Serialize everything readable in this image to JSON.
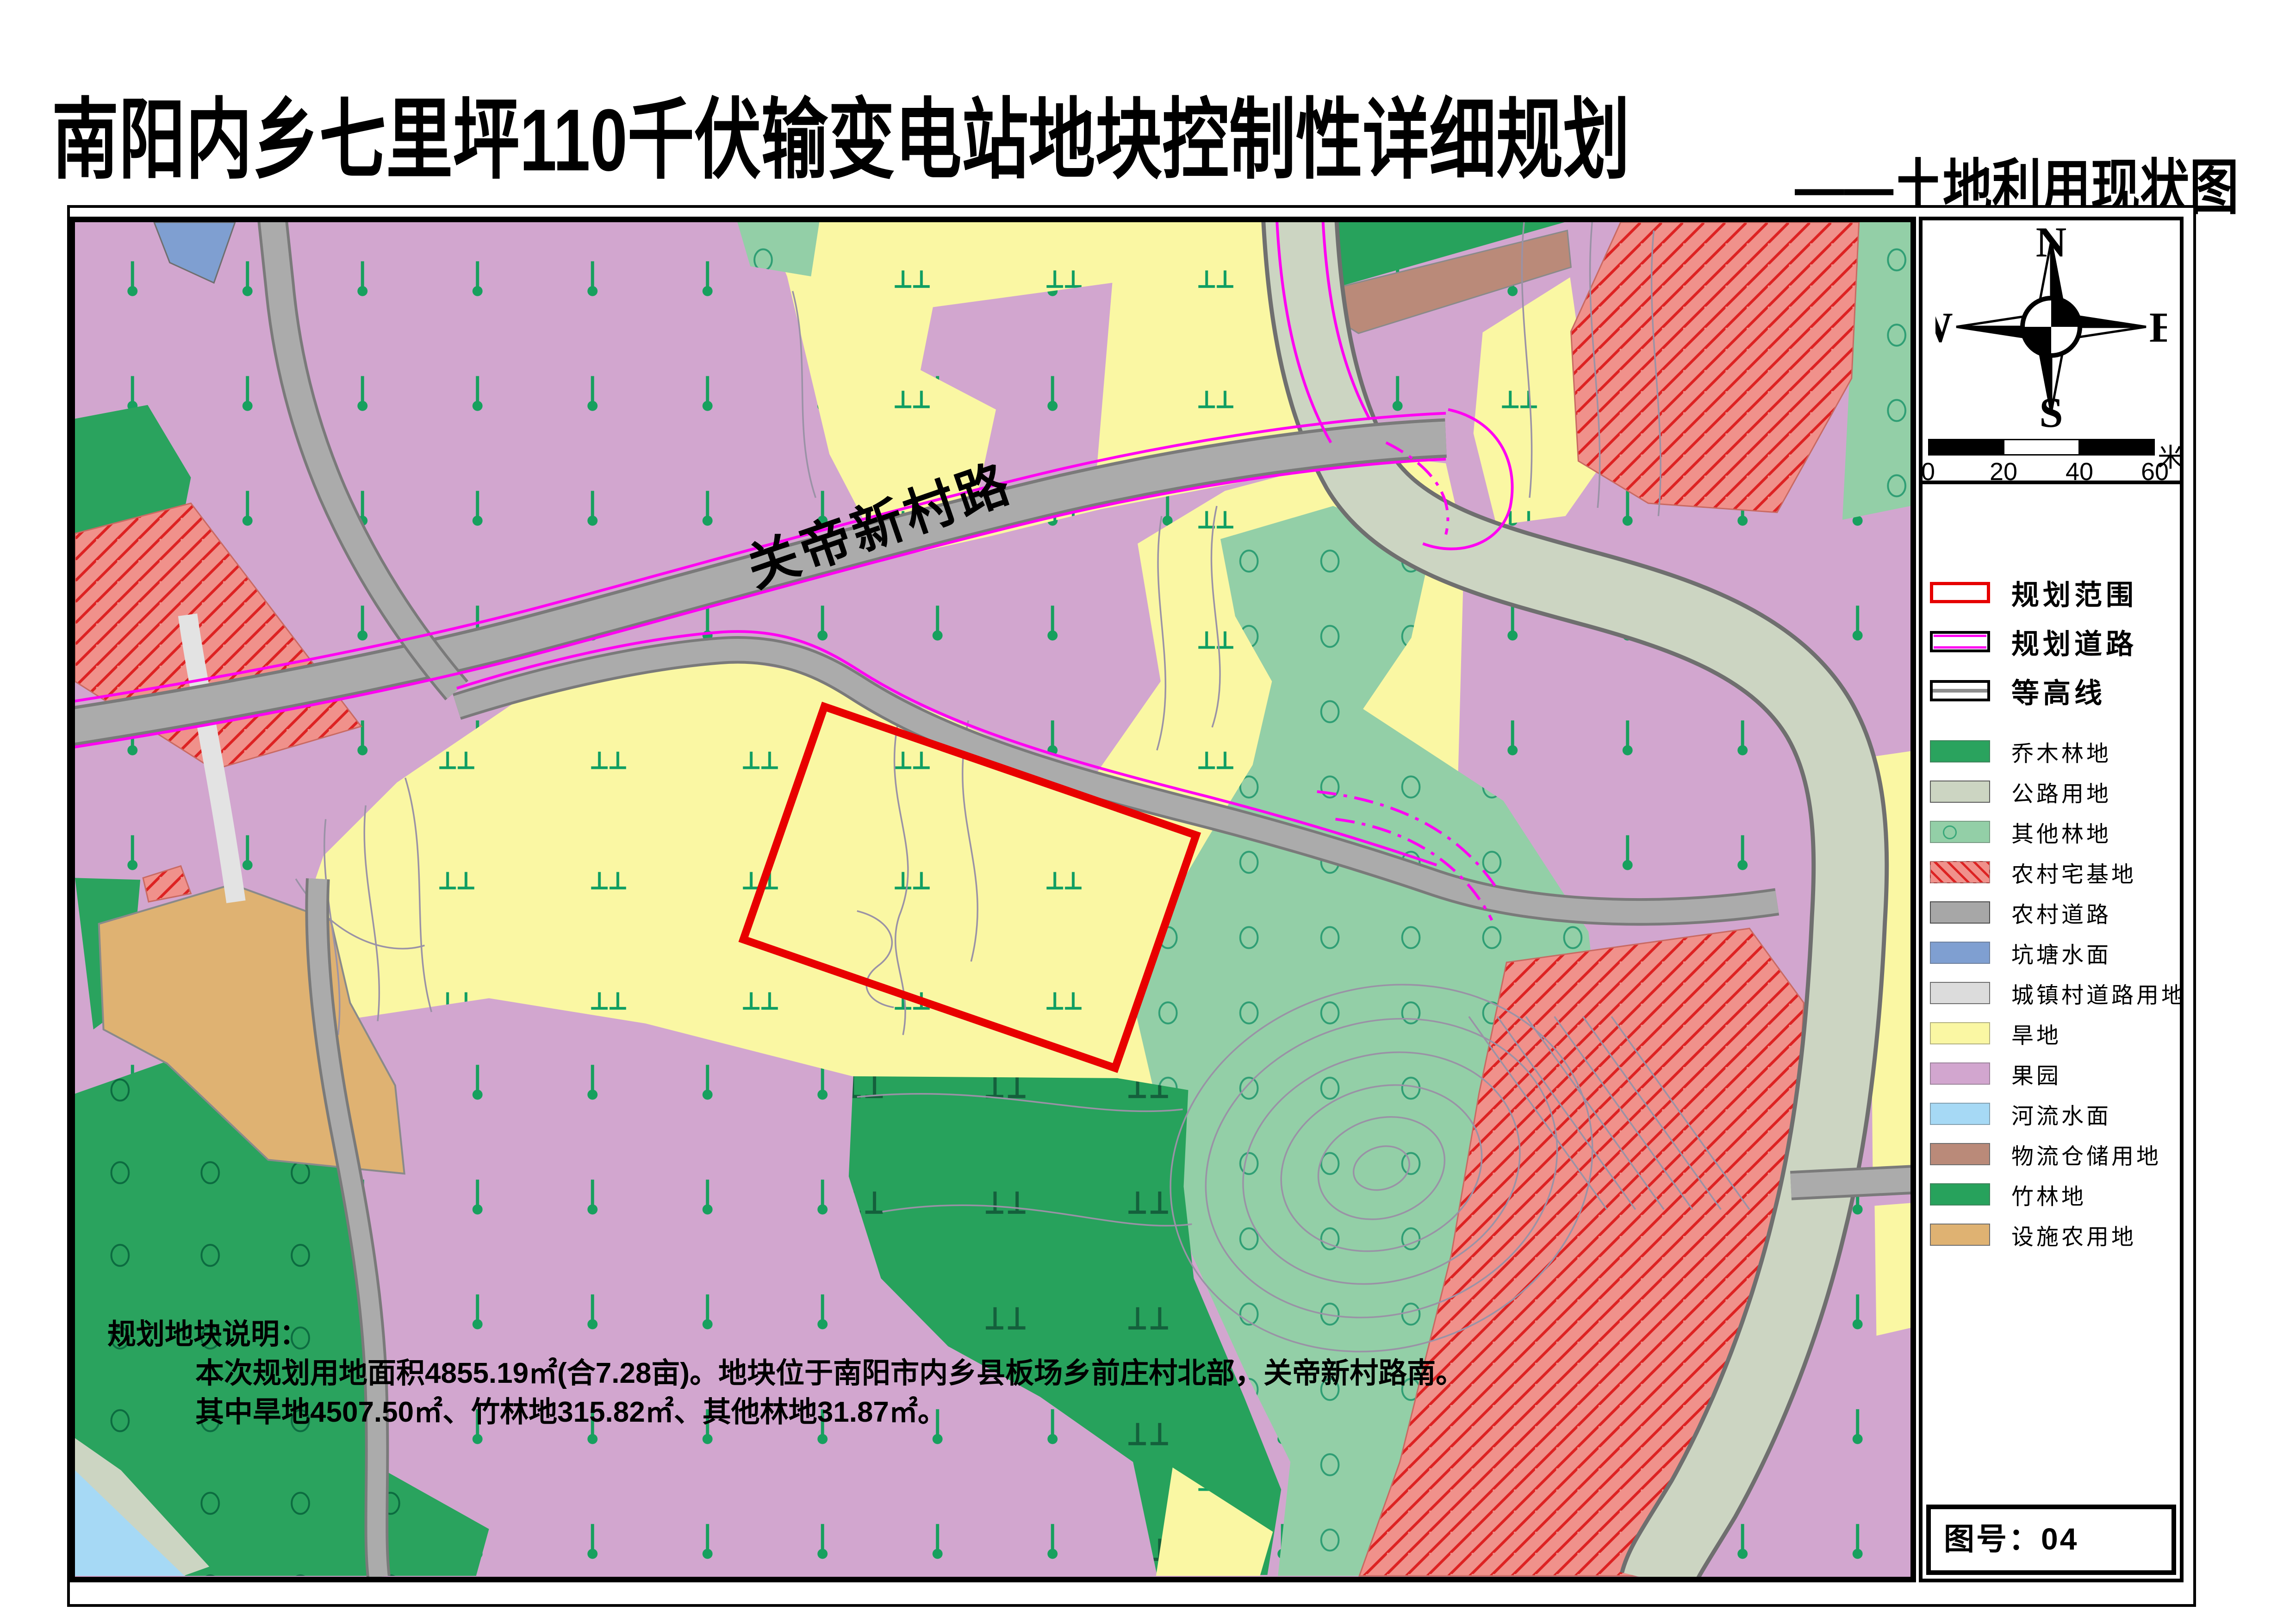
{
  "title": "南阳内乡七里坪110千伏输变电站地块控制性详细规划",
  "subtitle": "——土地利用现状图",
  "map": {
    "road_label": "关帝新村路"
  },
  "compass": {
    "n": "N",
    "e": "E",
    "s": "S",
    "w": "W"
  },
  "scale_bar": {
    "ticks": [
      "0",
      "20",
      "40",
      "60"
    ],
    "unit": "米"
  },
  "legend": {
    "line_items": [
      {
        "label": "规划范围",
        "type": "boundary",
        "color": "#e60000"
      },
      {
        "label": "规划道路",
        "type": "road",
        "color": "#ff00f2"
      },
      {
        "label": "等高线",
        "type": "contour",
        "color": "#8f8f8f"
      }
    ],
    "area_items": [
      {
        "label": "乔木林地",
        "color": "#2aa35e"
      },
      {
        "label": "公路用地",
        "color": "#ccd5c2",
        "border": "#5a5a5a"
      },
      {
        "label": "其他林地",
        "color": "#93cfa7",
        "symbol": "circle",
        "symbol_color": "#3aa87a"
      },
      {
        "label": "农村宅基地",
        "color": "#f0918b",
        "hatch": "#dd2222"
      },
      {
        "label": "农村道路",
        "color": "#a7a7a7",
        "border": "#4a4a4a"
      },
      {
        "label": "坑塘水面",
        "color": "#7f9fd1"
      },
      {
        "label": "城镇村道路用地",
        "color": "#dcdcdc",
        "border": "#6e6e6e"
      },
      {
        "label": "旱地",
        "color": "#faf7a3"
      },
      {
        "label": "果园",
        "color": "#d2a6cf"
      },
      {
        "label": "河流水面",
        "color": "#a6d9f5"
      },
      {
        "label": "物流仓储用地",
        "color": "#ba8a79",
        "border": "#6e6e6e"
      },
      {
        "label": "竹林地",
        "color": "#27a25c"
      },
      {
        "label": "设施农用地",
        "color": "#dfb272",
        "border": "#6e6e6e"
      }
    ]
  },
  "figure_number": {
    "label": "图号：04"
  },
  "notes": {
    "heading": "规划地块说明：",
    "line1": "本次规划用地面积4855.19㎡(合7.28亩)。地块位于南阳市内乡县板场乡前庄村北部，关帝新村路南。",
    "line2": "其中旱地4507.50㎡、竹林地315.82㎡、其他林地31.87㎡。"
  }
}
